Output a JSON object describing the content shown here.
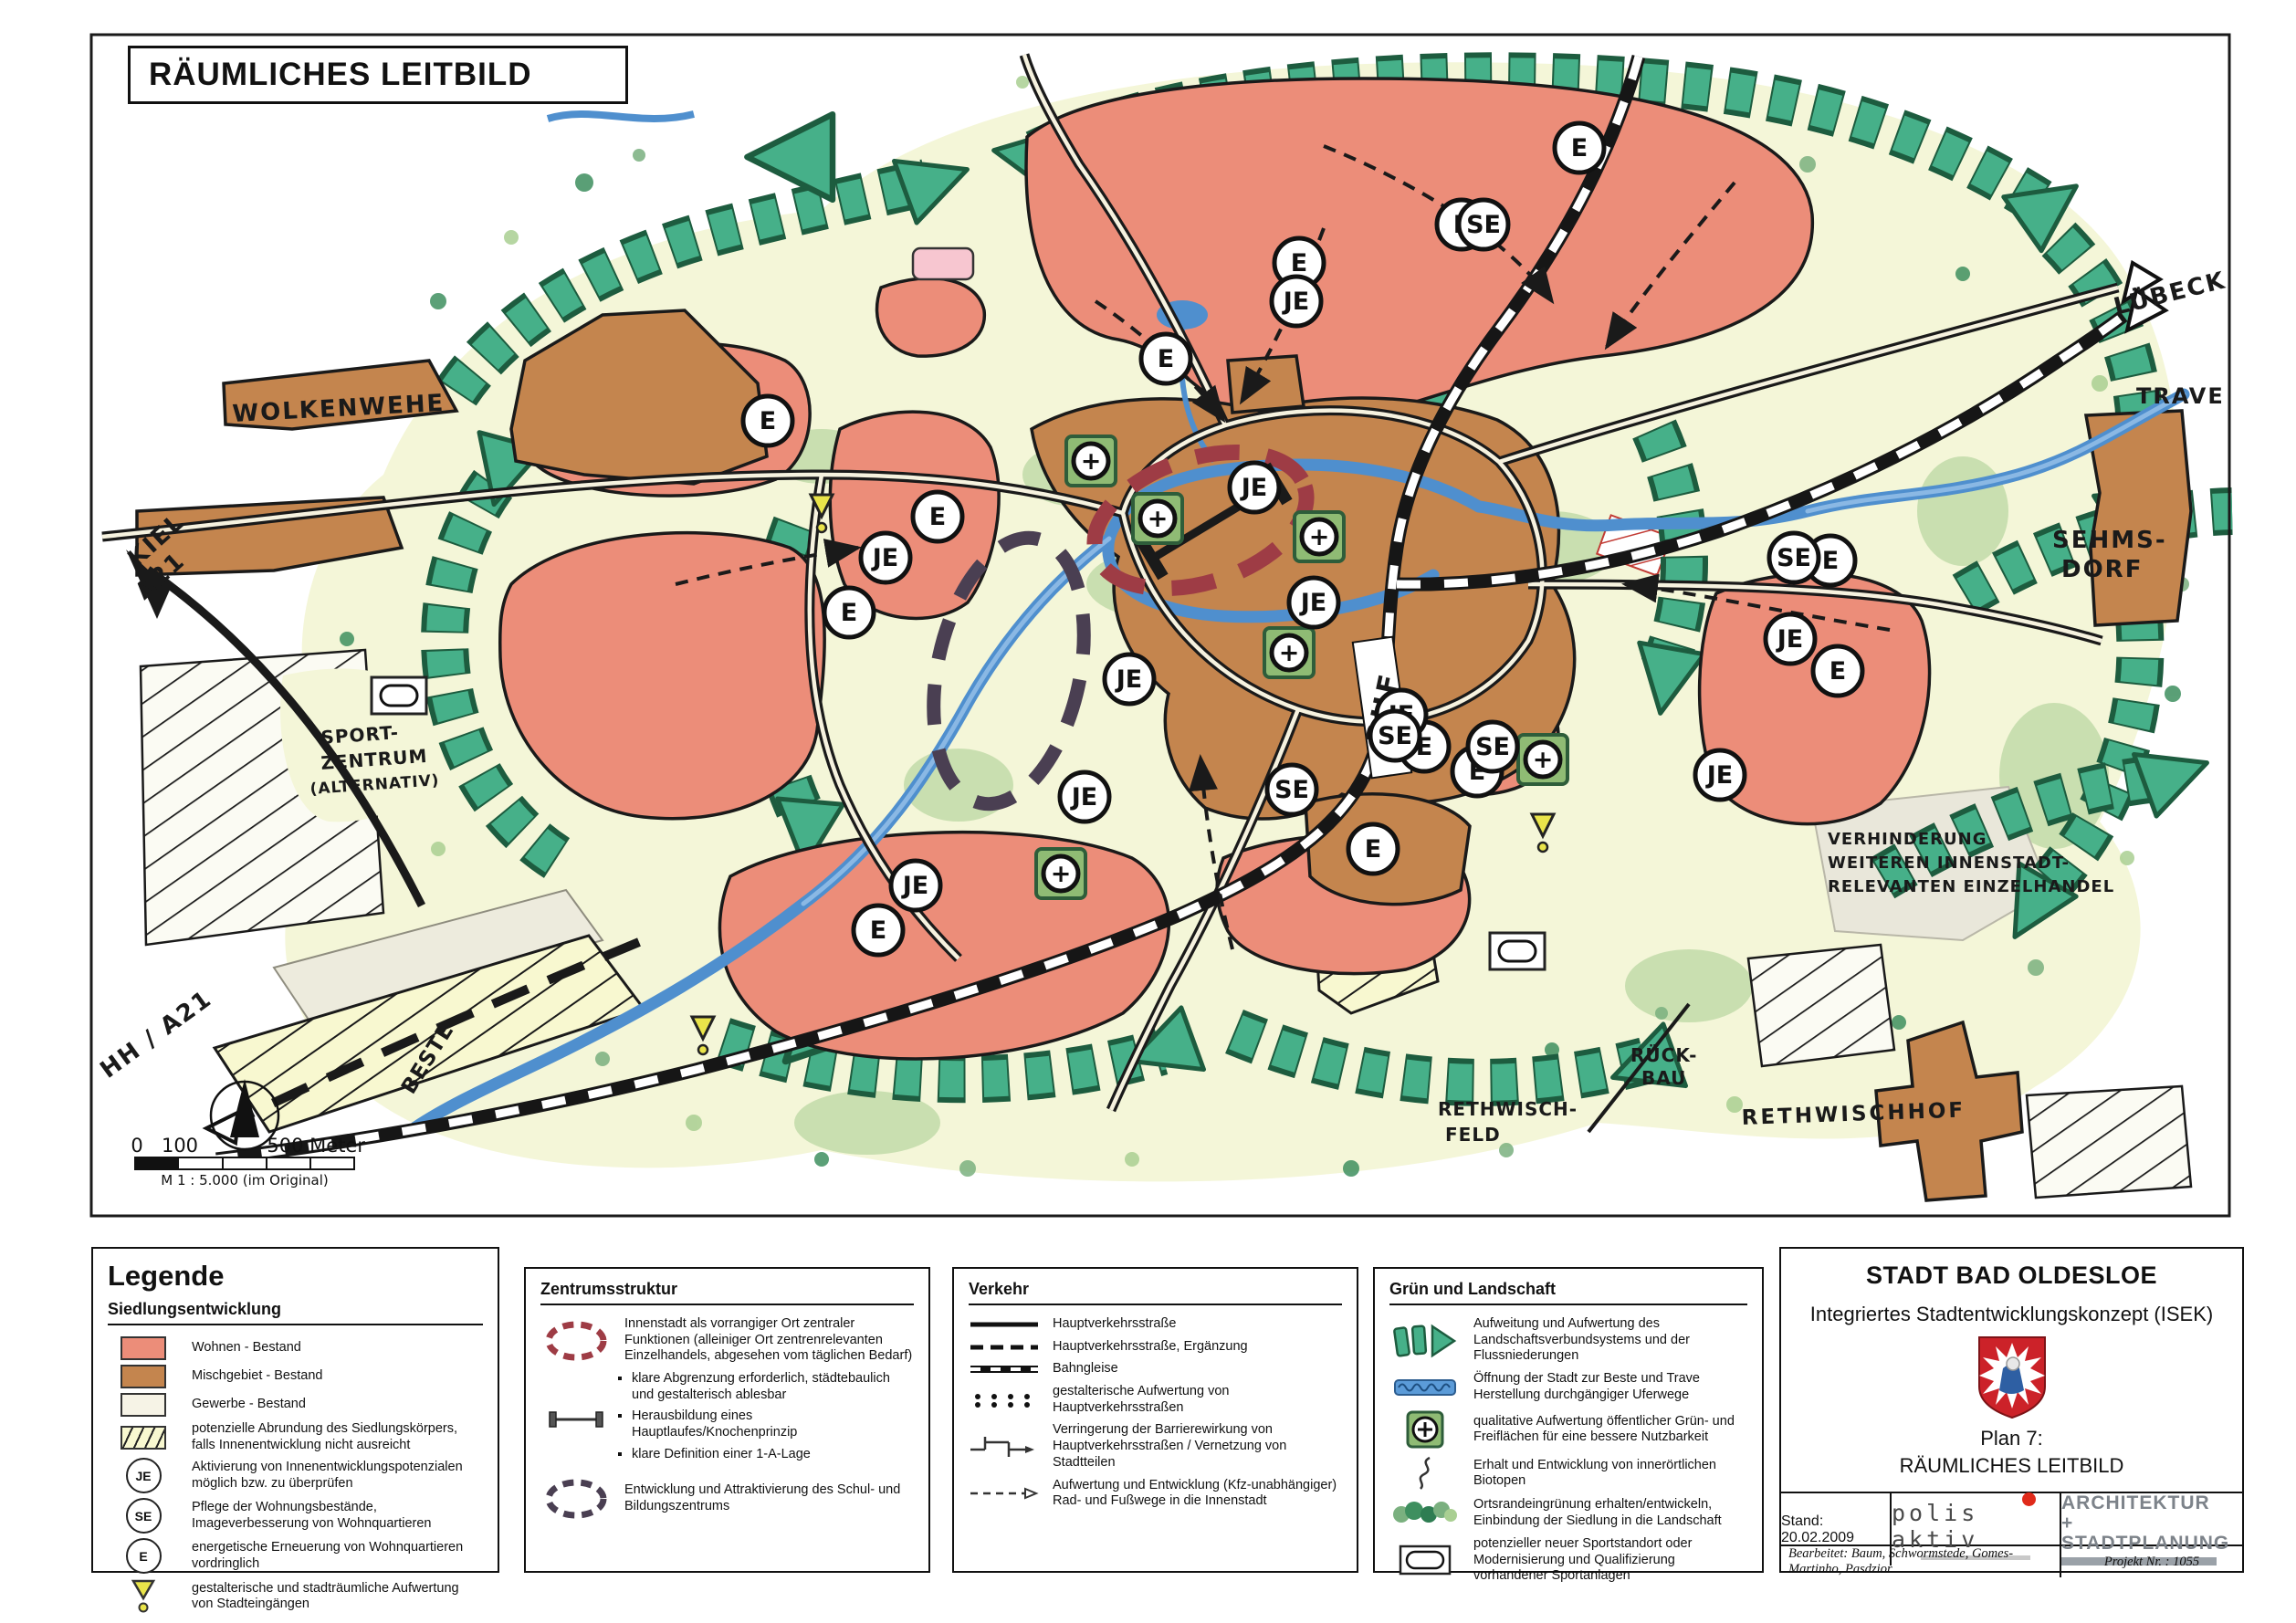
{
  "map": {
    "title": "RÄUMLICHES LEITBILD",
    "labels": {
      "wolkenwehe": "WOLKENWEHE",
      "kiel1": "KIEL",
      "kiel2": "A21",
      "hh": "HH / A21",
      "luebeck": "LÜBECK",
      "trave": "TRAVE",
      "sehmsdorf1": "SEHMS-",
      "sehmsdorf2": "DORF",
      "sport1": "SPORT-",
      "sport2": "ZENTRUM",
      "sport3": "(ALTERNATIV)",
      "verh1": "VERHINDERUNG",
      "verh2": "WEITEREN INNENSTADT-",
      "verh3": "RELEVANTEN EINZELHANDEL",
      "rfeld1": "RETHWISCH-",
      "rfeld2": "FELD",
      "rueck1": "RÜCK-",
      "rueck2": "BAU",
      "rethwischhof": "RETHWISCHHOF",
      "beste": "BESTE",
      "bhf": "BHF"
    },
    "symbols": {
      "e": "E",
      "je": "JE",
      "se": "SE",
      "plus": "+"
    },
    "scalebar": {
      "zero": "0",
      "hundred": "100",
      "five": "500 Meter",
      "ratio": "M 1 : 5.000 (im Original)"
    }
  },
  "legend": {
    "title": "Legende",
    "sections": [
      {
        "heading": "Siedlungsentwicklung",
        "items": [
          {
            "label": "Wohnen - Bestand"
          },
          {
            "label": "Mischgebiet - Bestand"
          },
          {
            "label": "Gewerbe - Bestand"
          },
          {
            "label": "potenzielle Abrundung des Siedlungskörpers, falls Innenentwicklung nicht ausreicht"
          },
          {
            "label": "Aktivierung von Innenentwicklungspotenzialen möglich bzw. zu überprüfen"
          },
          {
            "label": "Pflege der Wohnungsbestände, Imageverbesserung von Wohnquartieren"
          },
          {
            "label": "energetische Erneuerung von Wohnquartieren vordringlich"
          },
          {
            "label": "gestalterische und stadträumliche Aufwertung von Stadteingängen"
          }
        ]
      },
      {
        "heading": "Zentrumsstruktur",
        "items": [
          {
            "label": "Innenstadt als vorrangiger Ort zentraler Funktionen (alleiniger Ort zentrenrelevanten Einzelhandels, abgesehen vom täglichen Bedarf)"
          },
          {
            "label": "Entwicklung und Attraktivierung des Schul- und Bildungszentrums"
          }
        ],
        "bullets": [
          "klare Abgrenzung erforderlich, städtebaulich und gestalterisch ablesbar",
          "Herausbildung eines Hauptlaufes/Knochenprinzip",
          "klare Definition einer 1-A-Lage"
        ]
      },
      {
        "heading": "Verkehr",
        "items": [
          {
            "label": "Hauptverkehrsstraße"
          },
          {
            "label": "Hauptverkehrsstraße, Ergänzung"
          },
          {
            "label": "Bahngleise"
          },
          {
            "label": "gestalterische Aufwertung von Hauptverkehrsstraßen"
          },
          {
            "label": "Verringerung der Barrierewirkung von Hauptverkehrsstraßen / Vernetzung von Stadtteilen"
          },
          {
            "label": "Aufwertung und Entwicklung (Kfz-unabhängiger) Rad- und Fußwege in die Innenstadt"
          }
        ]
      },
      {
        "heading": "Grün und Landschaft",
        "items": [
          {
            "label": "Aufweitung und Aufwertung des Landschaftsverbundsystems und der Flussniederungen"
          },
          {
            "label": "Öffnung der Stadt zur Beste und Trave Herstellung durchgängiger Uferwege"
          },
          {
            "label": "qualitative Aufwertung öffentlicher Grün- und Freiflächen für eine bessere Nutzbarkeit"
          },
          {
            "label": "Erhalt und Entwicklung von innerörtlichen Biotopen"
          },
          {
            "label": "Ortsrandeingrünung erhalten/entwickeln, Einbindung der Siedlung in die Landschaft"
          },
          {
            "label": "potenzieller neuer Sportstandort oder Modernisierung und Qualifizierung vorhandener Sportanlagen"
          }
        ]
      }
    ]
  },
  "title_block": {
    "city": "STADT BAD OLDESLOE",
    "subtitle": "Integriertes Stadtentwicklungskonzept (ISEK)",
    "plan_label": "Plan 7:",
    "plan_name": "RÄUMLICHES LEITBILD",
    "stand": "Stand: 20.02.2009",
    "logo1": "polis aktiv",
    "logo2a": "ARCHITEKTUR",
    "logo2b": "+ STADTPLANUNG",
    "bearbeitet": "Bearbeitet:  Baum, Schwormstede, Gomes-Martinho, Pasdzior",
    "projekt": "Projekt Nr. : 1055"
  }
}
